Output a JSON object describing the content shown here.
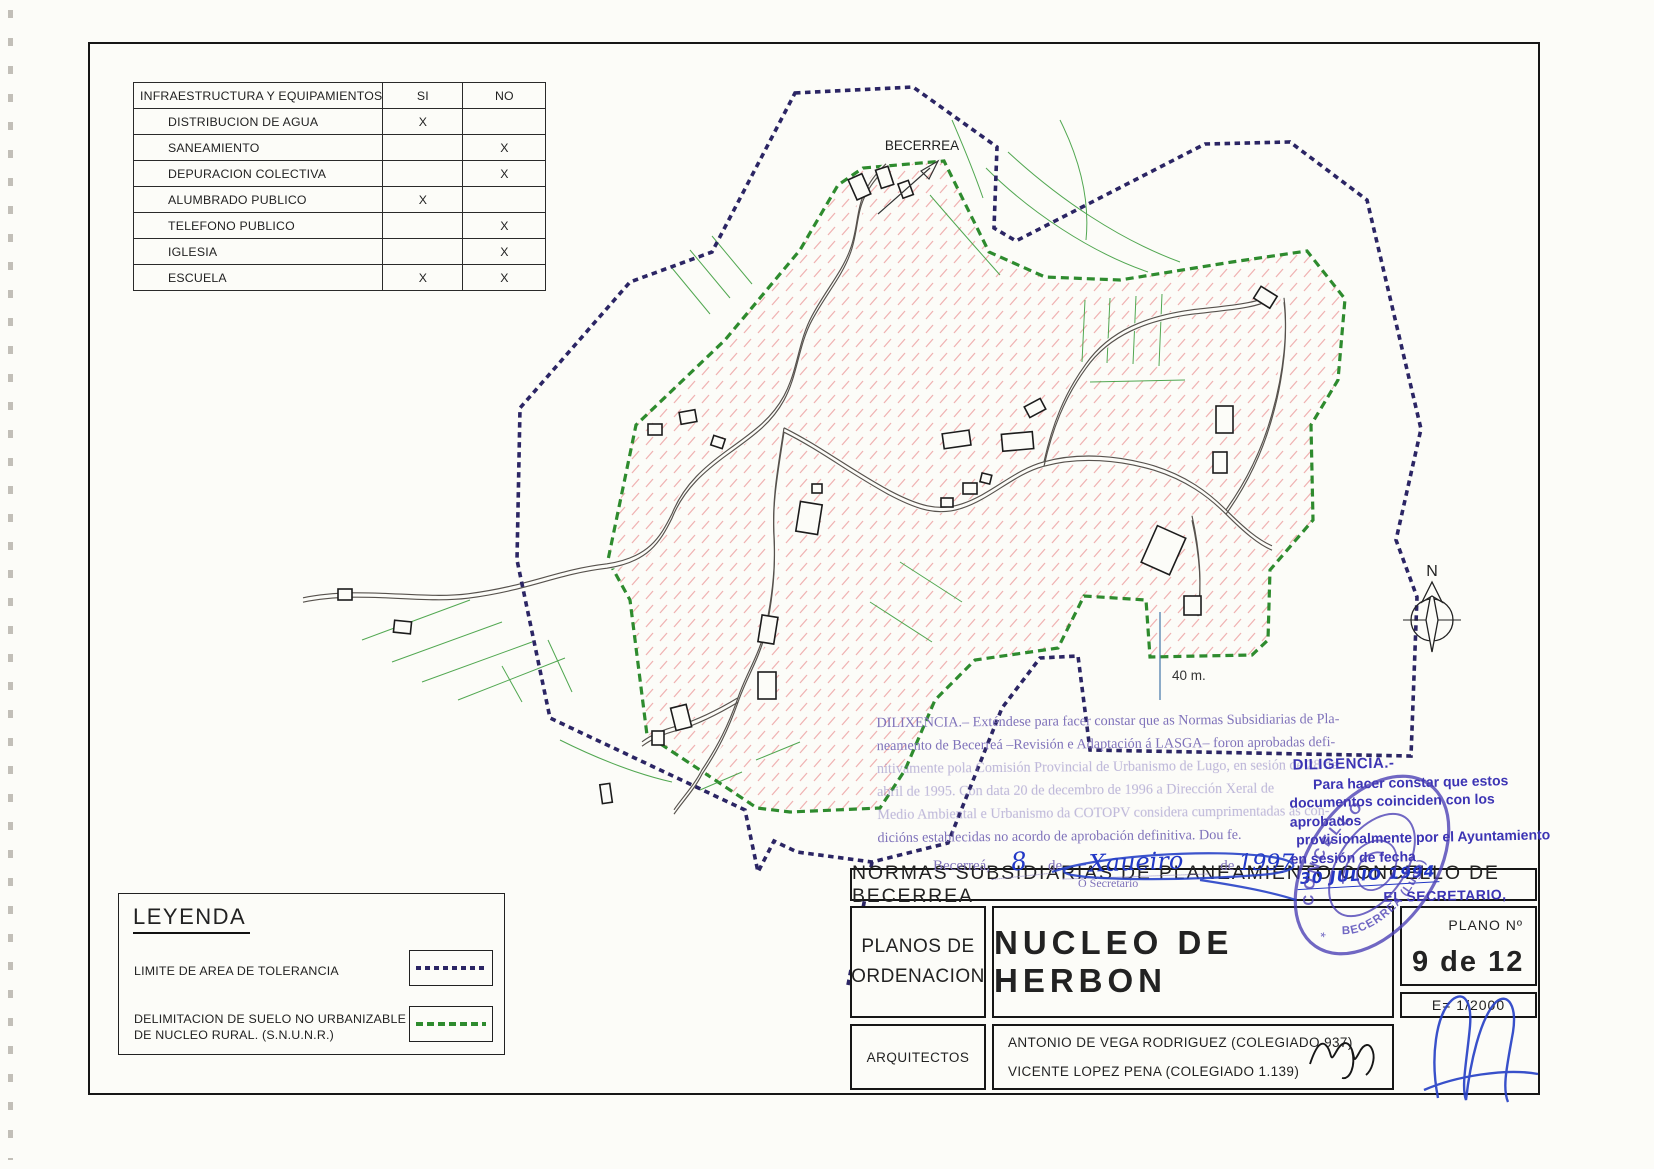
{
  "infra_table": {
    "header": {
      "col1": "INFRAESTRUCTURA Y EQUIPAMIENTOS",
      "col2": "SI",
      "col3": "NO"
    },
    "rows": [
      {
        "label": "DISTRIBUCION DE AGUA",
        "si": "X",
        "no": ""
      },
      {
        "label": "SANEAMIENTO",
        "si": "",
        "no": "X"
      },
      {
        "label": "DEPURACION COLECTIVA",
        "si": "",
        "no": "X"
      },
      {
        "label": "ALUMBRADO PUBLICO",
        "si": "X",
        "no": ""
      },
      {
        "label": "TELEFONO PUBLICO",
        "si": "",
        "no": "X"
      },
      {
        "label": "IGLESIA",
        "si": "",
        "no": "X"
      },
      {
        "label": "ESCUELA",
        "si": "X",
        "no": "X"
      }
    ]
  },
  "map": {
    "direction_label": "BECERREA",
    "scale_text": "40 m.",
    "north_letter": "N",
    "colors": {
      "tolerance_line": "#2b2564",
      "snunr_line": "#2e8b2e",
      "hatch": "#f0b2b2",
      "road": "#57524d",
      "parcel_line": "#3f9e3f"
    }
  },
  "legend": {
    "title": "LEYENDA",
    "item1_label": "LIMITE DE AREA DE TOLERANCIA",
    "item2_line1": "DELIMITACION DE SUELO NO URBANIZABLE",
    "item2_line2": "DE NUCLEO RURAL. (S.N.U.N.R.)"
  },
  "stamp_gl": {
    "lines": [
      "DILIXENCIA.– Exténdese para facer constar que as Normas Subsidiarias de Pla-",
      "neamento de Becerreá –Revisión e Adaptación á LASGA– foron aprobadas defi-",
      "nitivamente pola Comisión Provincial de Urbanismo de Lugo, en sesión de 28 de",
      "abril de 1995. Con data 20 de decembro de 1996 a Dirección Xeral de",
      "Medio Ambiental e Urbanismo da COTOPV considera cumprimentadas as con-",
      "dicións establecidas no acordo de aprobación definitiva. Dou fe."
    ],
    "date_prefix": "Becerreá,",
    "date_day": "8",
    "date_de1": "de",
    "date_month": "Xaueiro",
    "date_de2": "de",
    "date_year": "1997",
    "secretary": "O Secretario"
  },
  "stamp_es": {
    "title": "DILIGENCIA.-",
    "line1": "Para hacer constar que estos",
    "line2": "documentos coinciden con los aprobados",
    "line3": "provisionalmente por el  Ayuntamiento",
    "line4_prefix": "en sesión de fecha",
    "date_hand": "30 JULIO 1994",
    "signoff": "EL SECRETARIO,"
  },
  "seal": {
    "top_text": "CONCELLO",
    "bottom_text": "BECERREA (Lugo)",
    "star": "*"
  },
  "title_block": {
    "main_title": "NORMAS  SUBSIDIARIAS  DE  PLANEAMIENTO  CONCELLO  DE  BECERREA",
    "series_line1": "PLANOS  DE",
    "series_line2": "ORDENACION",
    "sheet_name": "NUCLEO  DE  HERBON",
    "plano_label": "PLANO  Nº",
    "plano_number": "9  de  12",
    "scale": "E=  1/2000",
    "architects_label": "ARQUITECTOS",
    "architect1": "ANTONIO DE VEGA RODRIGUEZ (COLEGIADO 937)",
    "architect2": "VICENTE LOPEZ PENA (COLEGIADO 1.139)"
  }
}
